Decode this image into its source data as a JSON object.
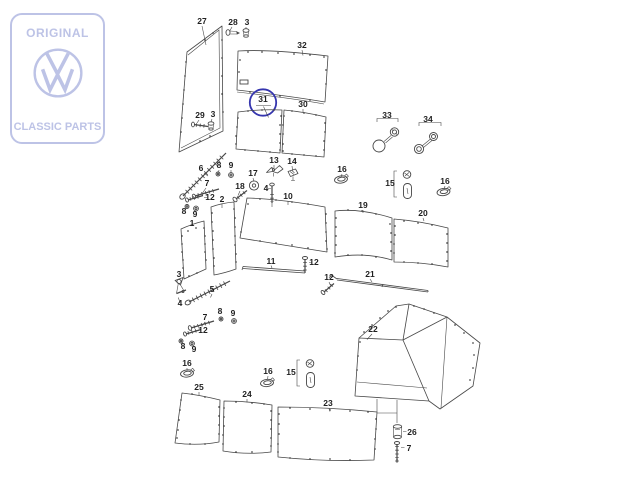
{
  "watermark": {
    "line1": "ORIGINAL",
    "line2": "CLASSIC PARTS",
    "brand_icon": "vw-roundel",
    "color": "#bdc3e6"
  },
  "diagram": {
    "type": "exploded-parts-diagram",
    "highlighted_part": "31",
    "highlight_color": "#3535ae",
    "line_color": "#474747",
    "label_color": "#1f1f1f",
    "labels": [
      {
        "part": "27",
        "x": 202,
        "y": 24
      },
      {
        "part": "28",
        "x": 233,
        "y": 25
      },
      {
        "part": "3",
        "x": 247,
        "y": 25
      },
      {
        "part": "32",
        "x": 302,
        "y": 48
      },
      {
        "part": "31",
        "x": 263,
        "y": 102
      },
      {
        "part": "30",
        "x": 303,
        "y": 107
      },
      {
        "part": "29",
        "x": 200,
        "y": 118
      },
      {
        "part": "3",
        "x": 213,
        "y": 117
      },
      {
        "part": "33",
        "x": 387,
        "y": 118
      },
      {
        "part": "34",
        "x": 428,
        "y": 122
      },
      {
        "part": "6",
        "x": 201,
        "y": 171
      },
      {
        "part": "8",
        "x": 219,
        "y": 168
      },
      {
        "part": "9",
        "x": 231,
        "y": 168
      },
      {
        "part": "13",
        "x": 274,
        "y": 163
      },
      {
        "part": "14",
        "x": 292,
        "y": 164
      },
      {
        "part": "16",
        "x": 342,
        "y": 172
      },
      {
        "part": "15",
        "x": 390,
        "y": 186
      },
      {
        "part": "16",
        "x": 445,
        "y": 184
      },
      {
        "part": "17",
        "x": 253,
        "y": 176
      },
      {
        "part": "7",
        "x": 207,
        "y": 186
      },
      {
        "part": "18",
        "x": 240,
        "y": 189
      },
      {
        "part": "4",
        "x": 266,
        "y": 191
      },
      {
        "part": "12",
        "x": 210,
        "y": 200
      },
      {
        "part": "10",
        "x": 288,
        "y": 199
      },
      {
        "part": "2",
        "x": 222,
        "y": 202
      },
      {
        "part": "19",
        "x": 363,
        "y": 208
      },
      {
        "part": "8",
        "x": 184,
        "y": 214
      },
      {
        "part": "9",
        "x": 195,
        "y": 217
      },
      {
        "part": "20",
        "x": 423,
        "y": 216
      },
      {
        "part": "1",
        "x": 192,
        "y": 226
      },
      {
        "part": "11",
        "x": 271,
        "y": 264
      },
      {
        "part": "12",
        "x": 314,
        "y": 265
      },
      {
        "part": "3",
        "x": 179,
        "y": 277
      },
      {
        "part": "21",
        "x": 370,
        "y": 277
      },
      {
        "part": "12",
        "x": 329,
        "y": 280
      },
      {
        "part": "5",
        "x": 212,
        "y": 292
      },
      {
        "part": "4",
        "x": 180,
        "y": 306
      },
      {
        "part": "8",
        "x": 220,
        "y": 314
      },
      {
        "part": "9",
        "x": 233,
        "y": 316
      },
      {
        "part": "7",
        "x": 205,
        "y": 320
      },
      {
        "part": "22",
        "x": 373,
        "y": 332
      },
      {
        "part": "12",
        "x": 203,
        "y": 333
      },
      {
        "part": "8",
        "x": 183,
        "y": 349
      },
      {
        "part": "9",
        "x": 194,
        "y": 352
      },
      {
        "part": "16",
        "x": 187,
        "y": 366
      },
      {
        "part": "16",
        "x": 268,
        "y": 374
      },
      {
        "part": "15",
        "x": 291,
        "y": 375
      },
      {
        "part": "25",
        "x": 199,
        "y": 390
      },
      {
        "part": "24",
        "x": 247,
        "y": 397
      },
      {
        "part": "23",
        "x": 328,
        "y": 406
      },
      {
        "part": "26",
        "x": 412,
        "y": 435
      },
      {
        "part": "7",
        "x": 409,
        "y": 451
      }
    ]
  }
}
